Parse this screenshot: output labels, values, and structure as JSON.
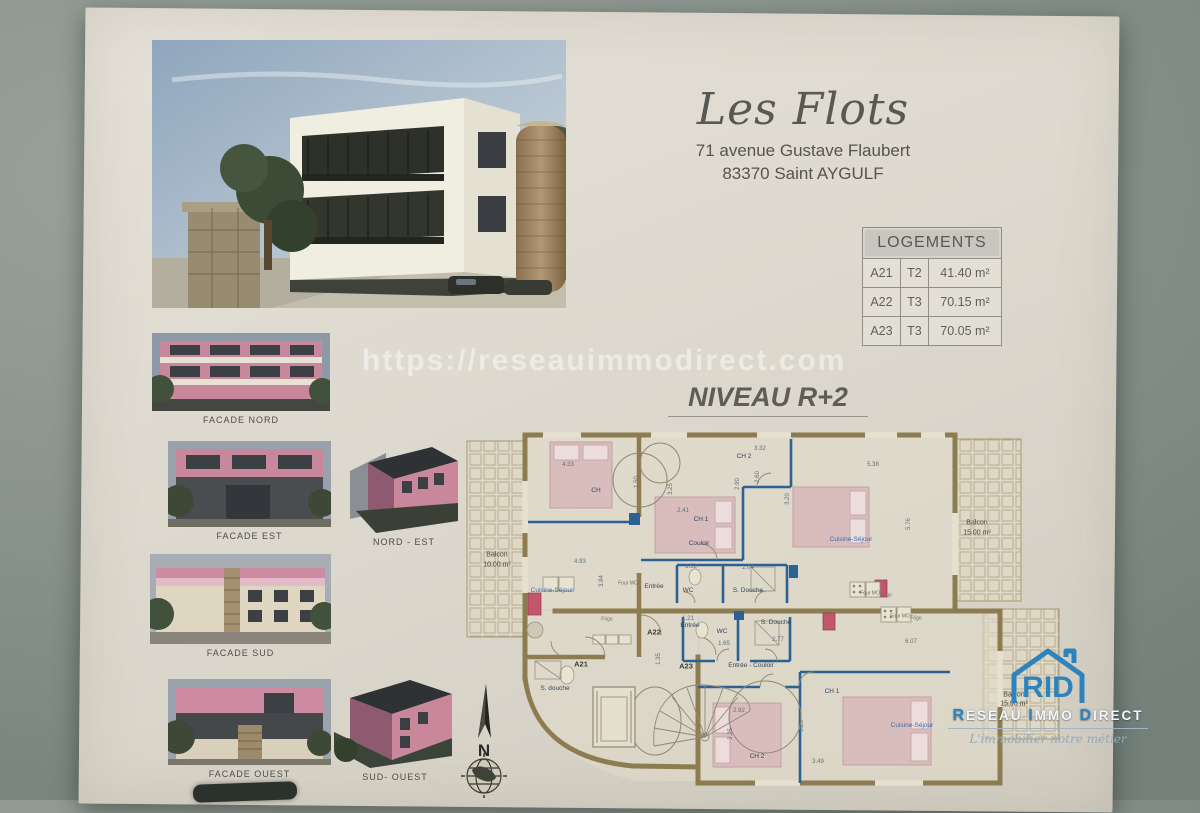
{
  "header": {
    "title": "Les Flots",
    "address_line1": "71 avenue Gustave Flaubert",
    "address_line2": "83370 Saint AYGULF"
  },
  "logements_table": {
    "title": "LOGEMENTS",
    "rows": [
      [
        "A21",
        "T2",
        "41.40 m²"
      ],
      [
        "A22",
        "T3",
        "70.15 m²"
      ],
      [
        "A23",
        "T3",
        "70.05 m²"
      ]
    ]
  },
  "watermark": {
    "text": "https://reseauimmodirect.com"
  },
  "level_heading": "NIVEAU R+2",
  "facades": [
    {
      "label": "FACADE NORD"
    },
    {
      "label": "FACADE EST"
    },
    {
      "label": "NORD - EST"
    },
    {
      "label": "FACADE SUD"
    },
    {
      "label": "FACADE OUEST"
    },
    {
      "label": "SUD- OUEST"
    }
  ],
  "compass": {
    "north_label": "N"
  },
  "logo": {
    "icon_text": "RID",
    "name_parts": [
      "R",
      "ESEAU ",
      "I",
      "MMO ",
      "D",
      "IRECT"
    ],
    "tagline": "L'immobilier notre métier",
    "accent_color": "#2f83bd"
  },
  "plan": {
    "labels": [
      {
        "t": "4.33",
        "x": 113,
        "y": 40,
        "c": "dim"
      },
      {
        "t": "1.50",
        "x": 182,
        "y": 57,
        "c": "dim",
        "r": 1
      },
      {
        "t": "4.93",
        "x": 125,
        "y": 137,
        "c": "dim"
      },
      {
        "t": "3.84",
        "x": 147,
        "y": 156,
        "c": "dim",
        "r": 1
      },
      {
        "t": "2.41",
        "x": 228,
        "y": 86,
        "c": "dim"
      },
      {
        "t": "3.25",
        "x": 216,
        "y": 64,
        "c": "dim",
        "r": 1
      },
      {
        "t": "3.32",
        "x": 305,
        "y": 24,
        "c": "dim"
      },
      {
        "t": "2.90",
        "x": 283,
        "y": 59,
        "c": "dim",
        "r": 1
      },
      {
        "t": "2.60",
        "x": 303,
        "y": 52,
        "c": "dim",
        "r": 1
      },
      {
        "t": "3.20",
        "x": 333,
        "y": 74,
        "c": "dim",
        "r": 1
      },
      {
        "t": "5.38",
        "x": 418,
        "y": 40,
        "c": "dim"
      },
      {
        "t": "5.76",
        "x": 454,
        "y": 99,
        "c": "dim",
        "r": 1
      },
      {
        "t": "1.52",
        "x": 236,
        "y": 142,
        "c": "dim"
      },
      {
        "t": "2.04",
        "x": 293,
        "y": 143,
        "c": "dim"
      },
      {
        "t": "1.21",
        "x": 233,
        "y": 194,
        "c": "dim"
      },
      {
        "t": "1.65",
        "x": 269,
        "y": 219,
        "c": "dim"
      },
      {
        "t": "2.77",
        "x": 323,
        "y": 215,
        "c": "dim"
      },
      {
        "t": "6.07",
        "x": 456,
        "y": 217,
        "c": "dim"
      },
      {
        "t": "2.92",
        "x": 284,
        "y": 286,
        "c": "dim"
      },
      {
        "t": "3.26",
        "x": 347,
        "y": 301,
        "c": "dim",
        "r": 1
      },
      {
        "t": "3.49",
        "x": 363,
        "y": 337,
        "c": "dim"
      },
      {
        "t": "3.25",
        "x": 276,
        "y": 309,
        "c": "dim",
        "r": 1
      },
      {
        "t": "1.35",
        "x": 204,
        "y": 234,
        "c": "dim",
        "r": 1
      },
      {
        "t": "CH",
        "x": 141,
        "y": 66,
        "c": "rm"
      },
      {
        "t": "CH 1",
        "x": 246,
        "y": 95,
        "c": "rm"
      },
      {
        "t": "CH 2",
        "x": 289,
        "y": 32,
        "c": "rm"
      },
      {
        "t": "Couloir",
        "x": 244,
        "y": 119,
        "c": "rm"
      },
      {
        "t": "Entrée",
        "x": 199,
        "y": 162,
        "c": "rm"
      },
      {
        "t": "WC",
        "x": 233,
        "y": 166,
        "c": "rm"
      },
      {
        "t": "S. Douche",
        "x": 293,
        "y": 166,
        "c": "rm"
      },
      {
        "t": "Entrée",
        "x": 235,
        "y": 201,
        "c": "rm"
      },
      {
        "t": "WC",
        "x": 267,
        "y": 207,
        "c": "rm"
      },
      {
        "t": "S. Douche",
        "x": 321,
        "y": 198,
        "c": "rm"
      },
      {
        "t": "Entrée - Couloir",
        "x": 296,
        "y": 241,
        "c": "rm"
      },
      {
        "t": "CH 1",
        "x": 377,
        "y": 267,
        "c": "rm"
      },
      {
        "t": "CH 2",
        "x": 302,
        "y": 332,
        "c": "rm"
      },
      {
        "t": "S. douche",
        "x": 100,
        "y": 264,
        "c": "rm"
      },
      {
        "t": "Cuisine-Séjour",
        "x": 97,
        "y": 166,
        "c": "cs"
      },
      {
        "t": "Cuisine-Séjour",
        "x": 396,
        "y": 115,
        "c": "cs"
      },
      {
        "t": "Cuisine-Séjour",
        "x": 457,
        "y": 301,
        "c": "cs"
      },
      {
        "t": "A21",
        "x": 126,
        "y": 239,
        "c": "apt"
      },
      {
        "t": "A22",
        "x": 199,
        "y": 207,
        "c": "apt"
      },
      {
        "t": "A23",
        "x": 231,
        "y": 241,
        "c": "apt"
      },
      {
        "t": "Balcon",
        "x": 42,
        "y": 130,
        "c": "balc"
      },
      {
        "t": "10.00 m²",
        "x": 42,
        "y": 140,
        "c": "balc"
      },
      {
        "t": "Balcon",
        "x": 522,
        "y": 98,
        "c": "balc"
      },
      {
        "t": "15.00 m²",
        "x": 522,
        "y": 108,
        "c": "balc"
      },
      {
        "t": "Balcon",
        "x": 559,
        "y": 270,
        "c": "balc"
      },
      {
        "t": "15.90 m²",
        "x": 559,
        "y": 279,
        "c": "balc"
      },
      {
        "t": "Four MO",
        "x": 173,
        "y": 159,
        "c": "tiny"
      },
      {
        "t": "Frigo",
        "x": 152,
        "y": 195,
        "c": "tiny"
      },
      {
        "t": "Four MO",
        "x": 415,
        "y": 169,
        "c": "tiny"
      },
      {
        "t": "Frigo",
        "x": 431,
        "y": 171,
        "c": "tiny"
      },
      {
        "t": "Four MO",
        "x": 445,
        "y": 192,
        "c": "tiny"
      },
      {
        "t": "Frigo",
        "x": 461,
        "y": 194,
        "c": "tiny"
      }
    ]
  }
}
